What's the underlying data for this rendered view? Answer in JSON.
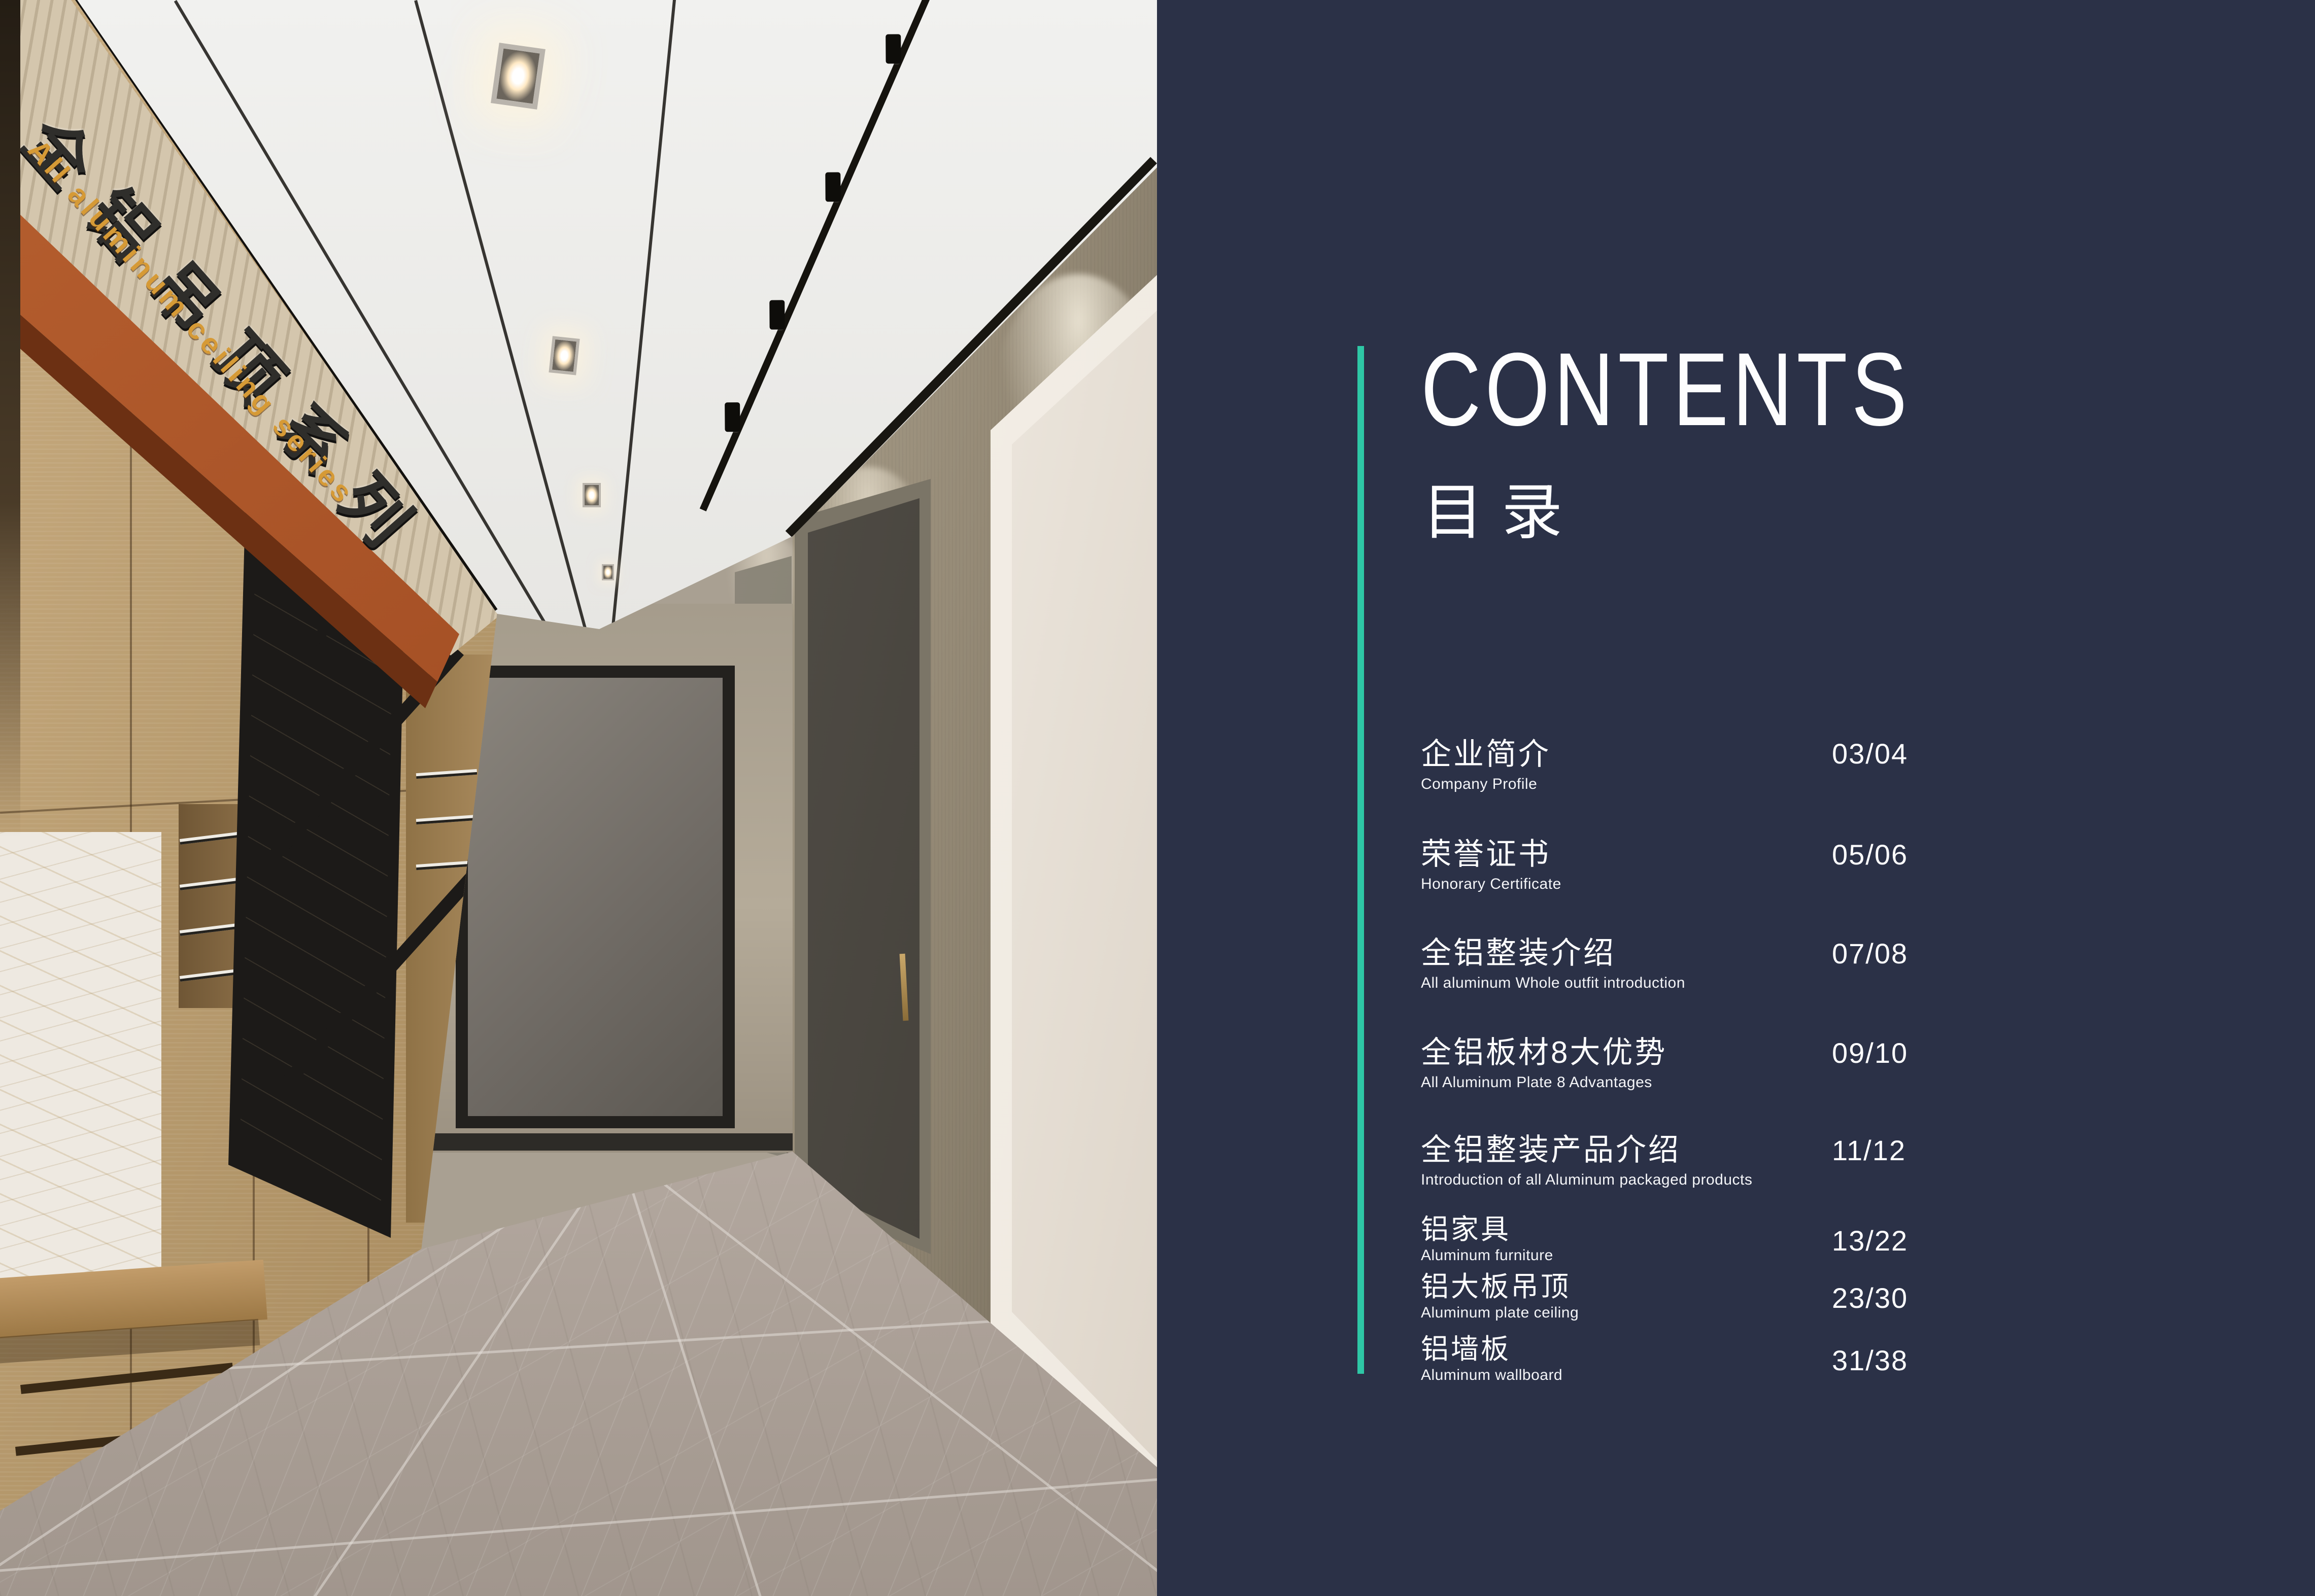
{
  "colors": {
    "accent": "#2ec7a6",
    "panel_bg": "#2b3147"
  },
  "header": {
    "title_en": "CONTENTS",
    "title_zh": "目录"
  },
  "toc": [
    {
      "zh": "企业简介",
      "en": "Company Profile",
      "pages": "03/04"
    },
    {
      "zh": "荣誉证书",
      "en": "Honorary Certificate",
      "pages": "05/06"
    },
    {
      "zh": "全铝整装介绍",
      "en": "All aluminum Whole outfit introduction",
      "pages": "07/08"
    },
    {
      "zh": "全铝板材8大优势",
      "en": "All Aluminum Plate 8 Advantages",
      "pages": "09/10"
    },
    {
      "zh": "全铝整装产品介绍",
      "en": "Introduction of all Aluminum packaged products",
      "pages": "11/12"
    },
    {
      "zh": "铝家具",
      "en": "Aluminum furniture",
      "pages": "13/22"
    },
    {
      "zh": "铝大板吊顶",
      "en": "Aluminum plate ceiling",
      "pages": "23/30"
    },
    {
      "zh": "铝墙板",
      "en": "Aluminum wallboard",
      "pages": "31/38"
    }
  ],
  "photo": {
    "signage_zh": "全铝吊顶系列",
    "signage_en": "All aluminum ceiling series"
  }
}
